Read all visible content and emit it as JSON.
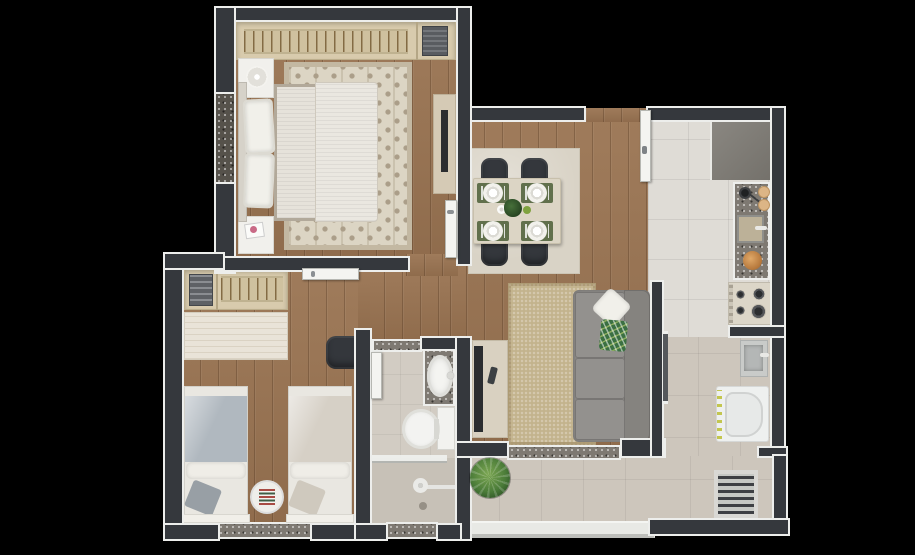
{
  "figure": {
    "type": "3D top-down apartment floor plan render",
    "visible_text": "",
    "background": "#000000"
  },
  "palette": {
    "wall": "#35383d",
    "wall_trim": "#edeeec",
    "wood_floor": "#9a7452",
    "kitchen_tile": "#dfdcd6",
    "service_tile": "#cdc6bc",
    "bath_tile": "#d2ccc3",
    "granite": "#7e7972",
    "furniture_white": "#f1f0ec",
    "wardrobe_beige": "#d8cbad",
    "sofa_gray": "#8f8d8a",
    "pillow_green": "#3b7042",
    "placemat_green": "#61704c",
    "chair_dark": "#34373c",
    "living_rug": "#c3b38d",
    "dining_rug": "#d9d3c6",
    "bedroom_rug": "#dcd5c4",
    "stove_cream": "#dcd6c8",
    "counter_gray": "#7d7a74",
    "plant_green": "#4a7b38",
    "blanket_blue": "#b0b8bf"
  },
  "rooms": [
    {
      "id": "master-bedroom",
      "label": "Master bedroom",
      "floor": "wood",
      "items": [
        "wardrobe with hangers",
        "storage basket",
        "double bed",
        "2 pillows",
        "2 nightstands",
        "decor tray",
        "magazine",
        "patterned area rug",
        "TV panel",
        "window"
      ]
    },
    {
      "id": "second-bedroom",
      "label": "Second bedroom",
      "floor": "wood",
      "items": [
        "wardrobe with hangers",
        "folded clothes",
        "desk",
        "office chair",
        "2 single beds",
        "round striped rug",
        "window"
      ]
    },
    {
      "id": "hallway",
      "label": "Hallway",
      "floor": "wood",
      "items": []
    },
    {
      "id": "bathroom",
      "label": "Bathroom",
      "floor": "tile",
      "items": [
        "granite vanity with oval sink",
        "toilet",
        "glass shower screen",
        "shower head",
        "floor drain",
        "window"
      ]
    },
    {
      "id": "living-dining",
      "label": "Living and dining room",
      "floor": "wood",
      "items": [
        "square dining table",
        "4 dark chairs",
        "4 green place settings with plates and cutlery",
        "centerpiece plant",
        "cup",
        "dining rug",
        "sofa with chaise",
        "white throw pillow",
        "green leaf throw pillow",
        "living rug",
        "TV console",
        "TV",
        "remote control",
        "sliding door"
      ]
    },
    {
      "id": "kitchen",
      "label": "Kitchen",
      "floor": "tile",
      "items": [
        "gray counter cabinet",
        "granite countertop",
        "frying pan",
        "2 cutting boards",
        "sink with faucet",
        "fruit bowl",
        "4-burner cooktop",
        "entrance door"
      ]
    },
    {
      "id": "laundry",
      "label": "Laundry area",
      "floor": "tile",
      "items": [
        "laundry tank",
        "top-load washing machine",
        "louvered heater cabinet"
      ]
    },
    {
      "id": "balcony",
      "label": "Balcony",
      "floor": "tile",
      "items": [
        "potted plant",
        "glass parapet",
        "granite sliding-door threshold"
      ]
    }
  ],
  "openings": {
    "doors": [
      "entrance door",
      "master bedroom door",
      "second bedroom door",
      "bathroom door",
      "balcony sliding door"
    ],
    "windows": [
      "master bedroom window",
      "second bedroom window",
      "bathroom window"
    ]
  }
}
